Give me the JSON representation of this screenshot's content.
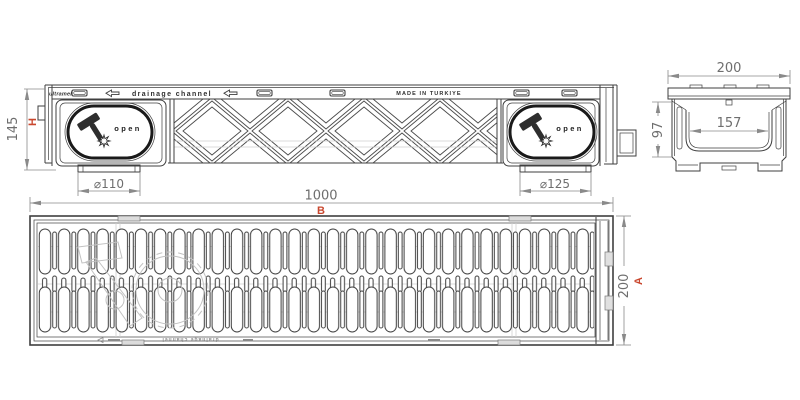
{
  "colors": {
    "accent": "#c9472e",
    "line": "#3f3f3f",
    "dimension": "#8a8a8a"
  },
  "icons": {
    "hammer": "hammer glyph inside oval cover and faint grate watermark",
    "burst": "8-point star burst beside hammer",
    "arrow_left": "outline left-pointing arrow on top rail",
    "slot": "small rounded slot on top rail"
  },
  "side_view": {
    "logo_text": "ultramele",
    "rail_text": "drainage channel",
    "made_in_text": "MADE IN TURKIYE",
    "open_label": "open",
    "dim_height": "145",
    "dim_height_letter": "H",
    "dim_outlet_left": "⌀110",
    "dim_outlet_right": "⌀125"
  },
  "section_view": {
    "dim_width": "200",
    "dim_depth": "97",
    "dim_inner_width": "157"
  },
  "plan_view": {
    "dim_length": "1000",
    "dim_length_letter": "B",
    "dim_width": "200",
    "dim_width_letter": "A",
    "footer_text": "drainage channel"
  }
}
